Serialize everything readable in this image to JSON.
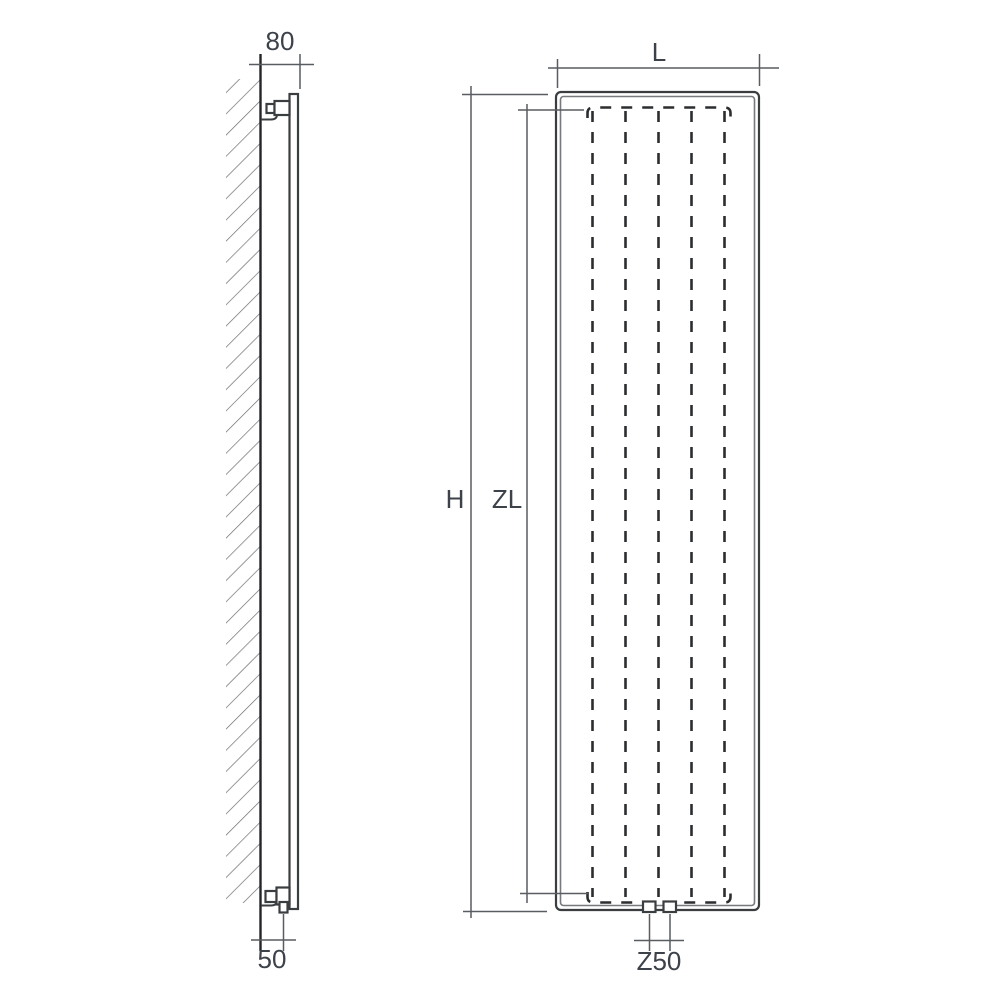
{
  "drawing": {
    "title": "vertical-radiator-dimension-drawing",
    "views": {
      "side_view": "wall-mounted-profile",
      "front_view": "panel-face"
    },
    "labels": {
      "depth": "80",
      "wall_clearance": "50",
      "width": "L",
      "height": "H",
      "center_length": "ZL",
      "connection_spacing": "Z50"
    },
    "colors": {
      "background": "#ffffff",
      "outline": "#3b3e41",
      "wall_line": "#232528",
      "inner_outline": "#77797c",
      "hidden_line": "#2b2d2f",
      "dimension_line": "#595c60",
      "hatch": "#6a6d71",
      "text": "#3c414a"
    }
  }
}
